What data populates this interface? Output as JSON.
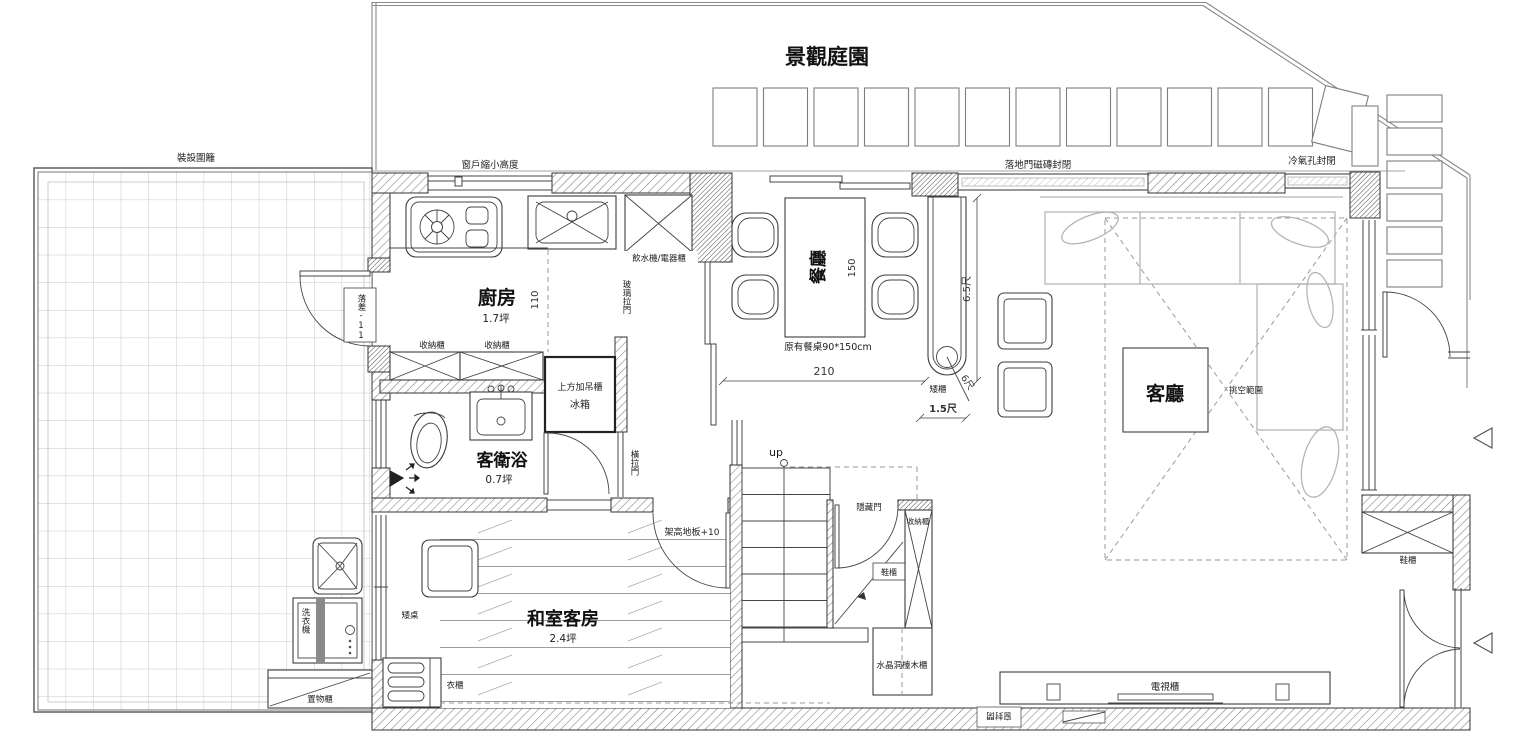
{
  "garden": {
    "title": "景觀庭園",
    "fence": "裝設圍籬"
  },
  "notes": {
    "window_height": "窗戶縮小高度",
    "patio_door": "落地門磁磚封閉",
    "ac_hole": "冷氣孔封閉",
    "level": "落差-11",
    "glass_door": "玻璃拉門",
    "slide_door": "橫拉門",
    "raised_floor": "架高地板+10",
    "hidden_door": "隱藏門",
    "sealed_window": "窗封閉",
    "void_area": "挑空範圍",
    "stair_up": "up"
  },
  "rooms": {
    "kitchen": {
      "name": "廚房",
      "area": "1.7坪"
    },
    "bathroom": {
      "name": "客衛浴",
      "area": "0.7坪"
    },
    "dining": {
      "name": "餐廳"
    },
    "living": {
      "name": "客廳"
    },
    "tatami": {
      "name": "和室客房",
      "area": "2.4坪"
    }
  },
  "cabinets": {
    "water_appliance": "飲水機/電器櫃",
    "storage_a": "收納櫃",
    "storage_b": "收納櫃",
    "upper": "上方加吊櫃",
    "fridge": "冰箱",
    "low_cabinet": "矮櫃",
    "low_table": "矮桌",
    "wardrobe": "衣櫃",
    "shoe_under_stair": "鞋櫃",
    "shoe_entry": "鞋櫃",
    "storage_stair": "收納櫃",
    "crystal": "水晶洞檯木櫃",
    "tv": "電視櫃",
    "shelf": "置物櫃",
    "washer": "洗衣機"
  },
  "dims": {
    "table_note": "原有餐桌90*150cm",
    "d210": "210",
    "d150": "150",
    "d110": "110",
    "d65": "6.5尺",
    "d6": "6尺",
    "d15": "1.5尺"
  }
}
